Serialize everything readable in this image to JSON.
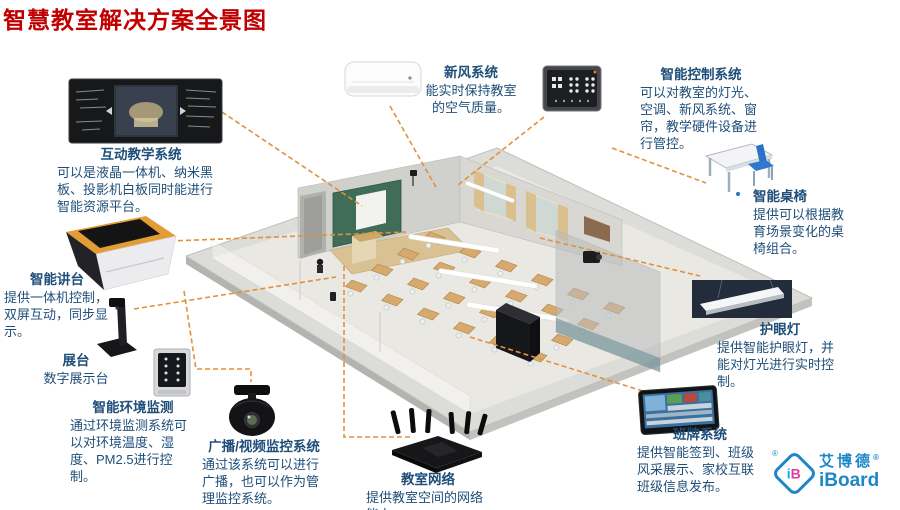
{
  "title": "智慧教室解决方案全景图",
  "colors": {
    "title": "#C00000",
    "text": "#1F4E79",
    "callout_line": "#E2903C",
    "logo_blue": "#1E87C9"
  },
  "center_image": "isometric-smart-classroom-rendering",
  "sections": {
    "interactive_teaching": {
      "title": "互动教学系统",
      "desc": "可以是液晶一体机、纳米黑板、投影机白板同时能进行智能资源平台。",
      "image": "interactive-blackboard-panel"
    },
    "smart_podium": {
      "title": "智能讲台",
      "desc": "提供一体机控制，双屏互动，同步显示。",
      "image": "smart-lectern"
    },
    "visualizer": {
      "title": "展台",
      "desc": "数字展示台",
      "image": "document-camera"
    },
    "env_monitor": {
      "title": "智能环境监测",
      "desc": "通过环境监测系统可以对环境温度、湿度、PM2.5进行控制。",
      "image": "environment-sensor-panel"
    },
    "broadcast": {
      "title": "广播/视频监控系统",
      "desc": "通过该系统可以进行广播，也可以作为管理监控系统。",
      "image": "ptz-surveillance-camera"
    },
    "network": {
      "title": "教室网络",
      "desc": "提供教室空间的网络能力。",
      "image": "wifi-router"
    },
    "fresh_air": {
      "title": "新风系统",
      "desc": "能实时保持教室的空气质量。",
      "image": "wall-air-conditioner"
    },
    "control": {
      "title": "智能控制系统",
      "desc": "可以对教室的灯光、空调、新风系统、窗帘，教学硬件设备进行管控。",
      "image": "touch-control-panel"
    },
    "smart_desks": {
      "title": "智能桌椅",
      "desc": "提供可以根据教育场景变化的桌椅组合。",
      "image": "school-desk-and-chair"
    },
    "eye_lamp": {
      "title": "护眼灯",
      "desc": "提供智能护眼灯，并能对灯光进行实时控制。",
      "image": "led-classroom-light"
    },
    "class_sign": {
      "title": "班牌系统",
      "desc": "提供智能签到、班级风采展示、家校互联班级信息发布。",
      "image": "class-sign-tablet"
    }
  },
  "logo": {
    "cn": "艾博德",
    "en": "iBoard",
    "reg": "®",
    "mono_i": "i",
    "mono_b": "B"
  }
}
